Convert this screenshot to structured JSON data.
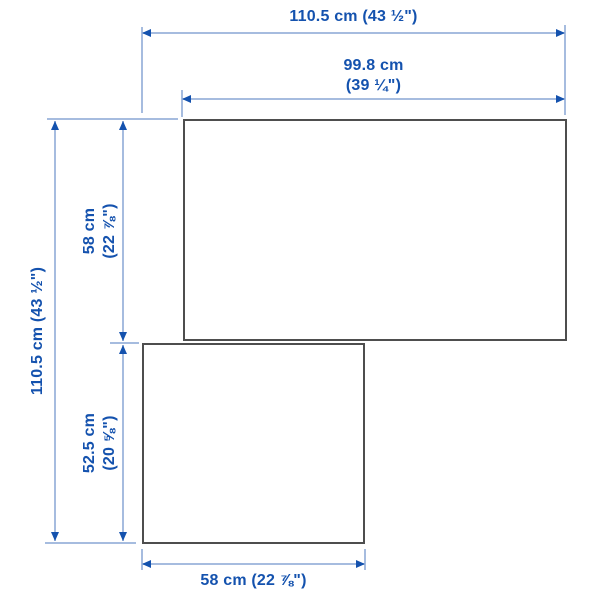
{
  "diagram": {
    "type": "product-dimension-diagram",
    "units": [
      "cm",
      "inch"
    ],
    "dimensions": {
      "total_width": {
        "text": "110.5 cm (43 ½\")"
      },
      "upper_width": {
        "line1": "99.8 cm",
        "line2": "(39 ¼\")"
      },
      "total_height": {
        "text": "110.5 cm (43 ½\")"
      },
      "upper_height": {
        "line1": "58 cm",
        "line2": "(22 ⅞\")"
      },
      "lower_height": {
        "line1": "52.5 cm",
        "line2": "(20 ⅝\")"
      },
      "lower_width": {
        "text": "58 cm (22 ⅞\")"
      }
    },
    "shapes": {
      "upper_unit": {
        "width_cm": 99.8,
        "depth_cm": 58
      },
      "lower_unit": {
        "width_cm": 58,
        "depth_cm": 52.5
      }
    },
    "colors": {
      "dimension_text_blue": "#1452ae",
      "dimension_line_pale_blue": "#a6bcdf",
      "outline_gray": "#4e4e4e",
      "background": "#ffffff"
    }
  }
}
